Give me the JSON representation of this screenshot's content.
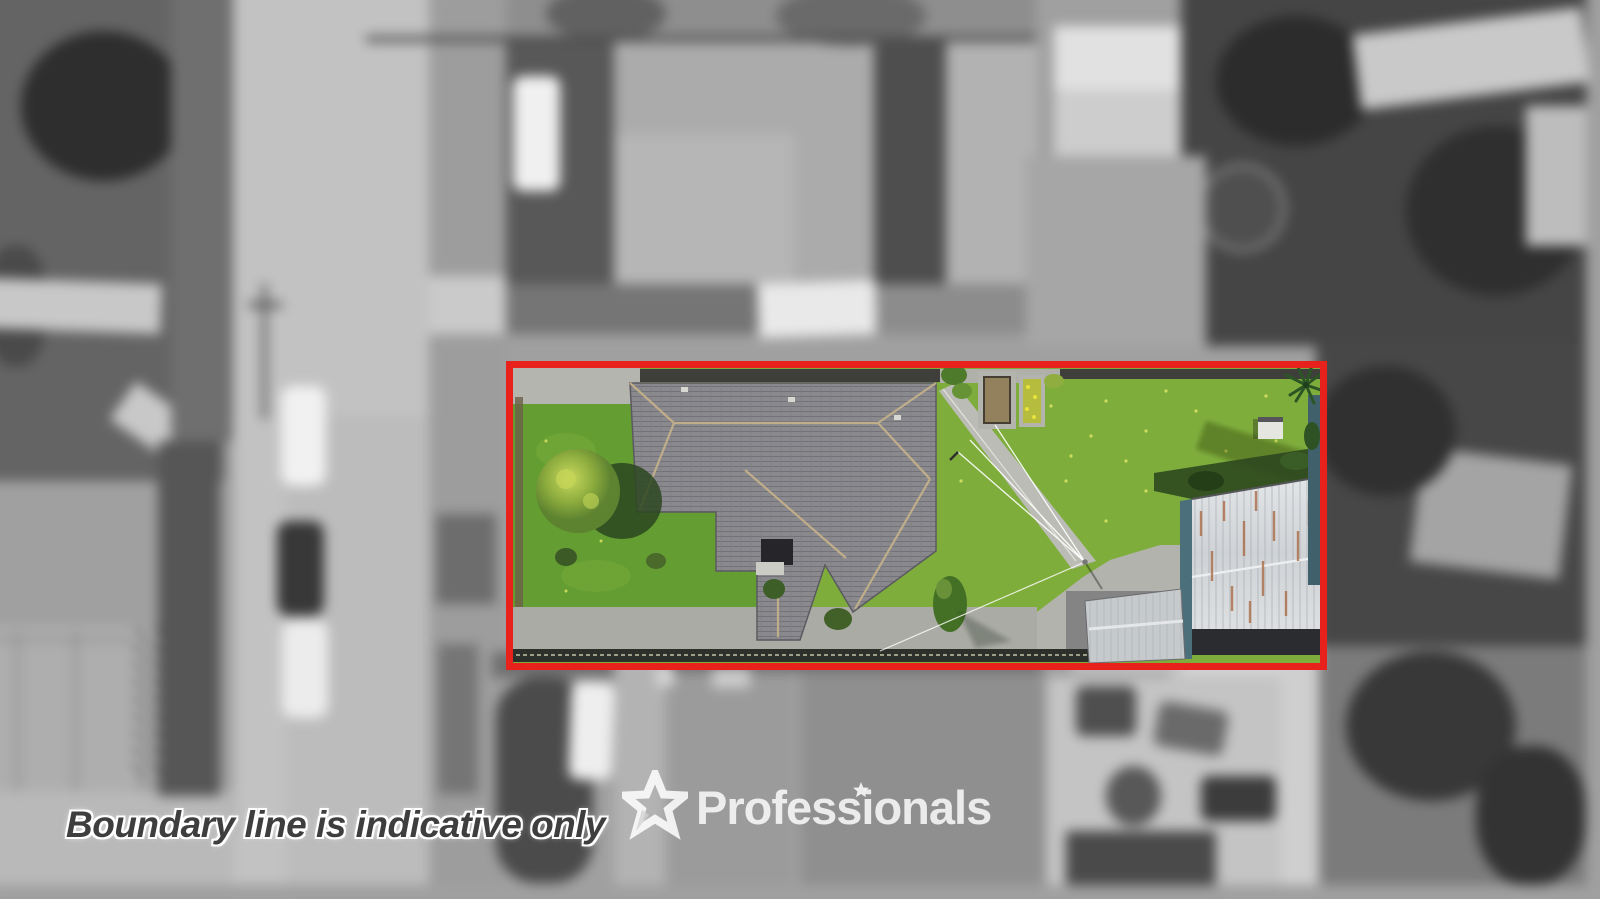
{
  "image_type": "aerial-property-photo",
  "watermark": {
    "disclaimer_text": "Boundary line is indicative only",
    "brand_name": "Professionals"
  },
  "palette": {
    "boundary_red": "#e8211d",
    "backyard_lawn_green": "#7fad3c",
    "front_lawn_green": "#649d31",
    "house_roof_gray": "#8a898e",
    "concrete_gray": "#b5b5b0",
    "shed_roof_silver": "#d8dadc",
    "shed_wall_teal": "#4b6f7b",
    "soil_brown": "#93815e",
    "background_style": "blurred grayscale"
  }
}
